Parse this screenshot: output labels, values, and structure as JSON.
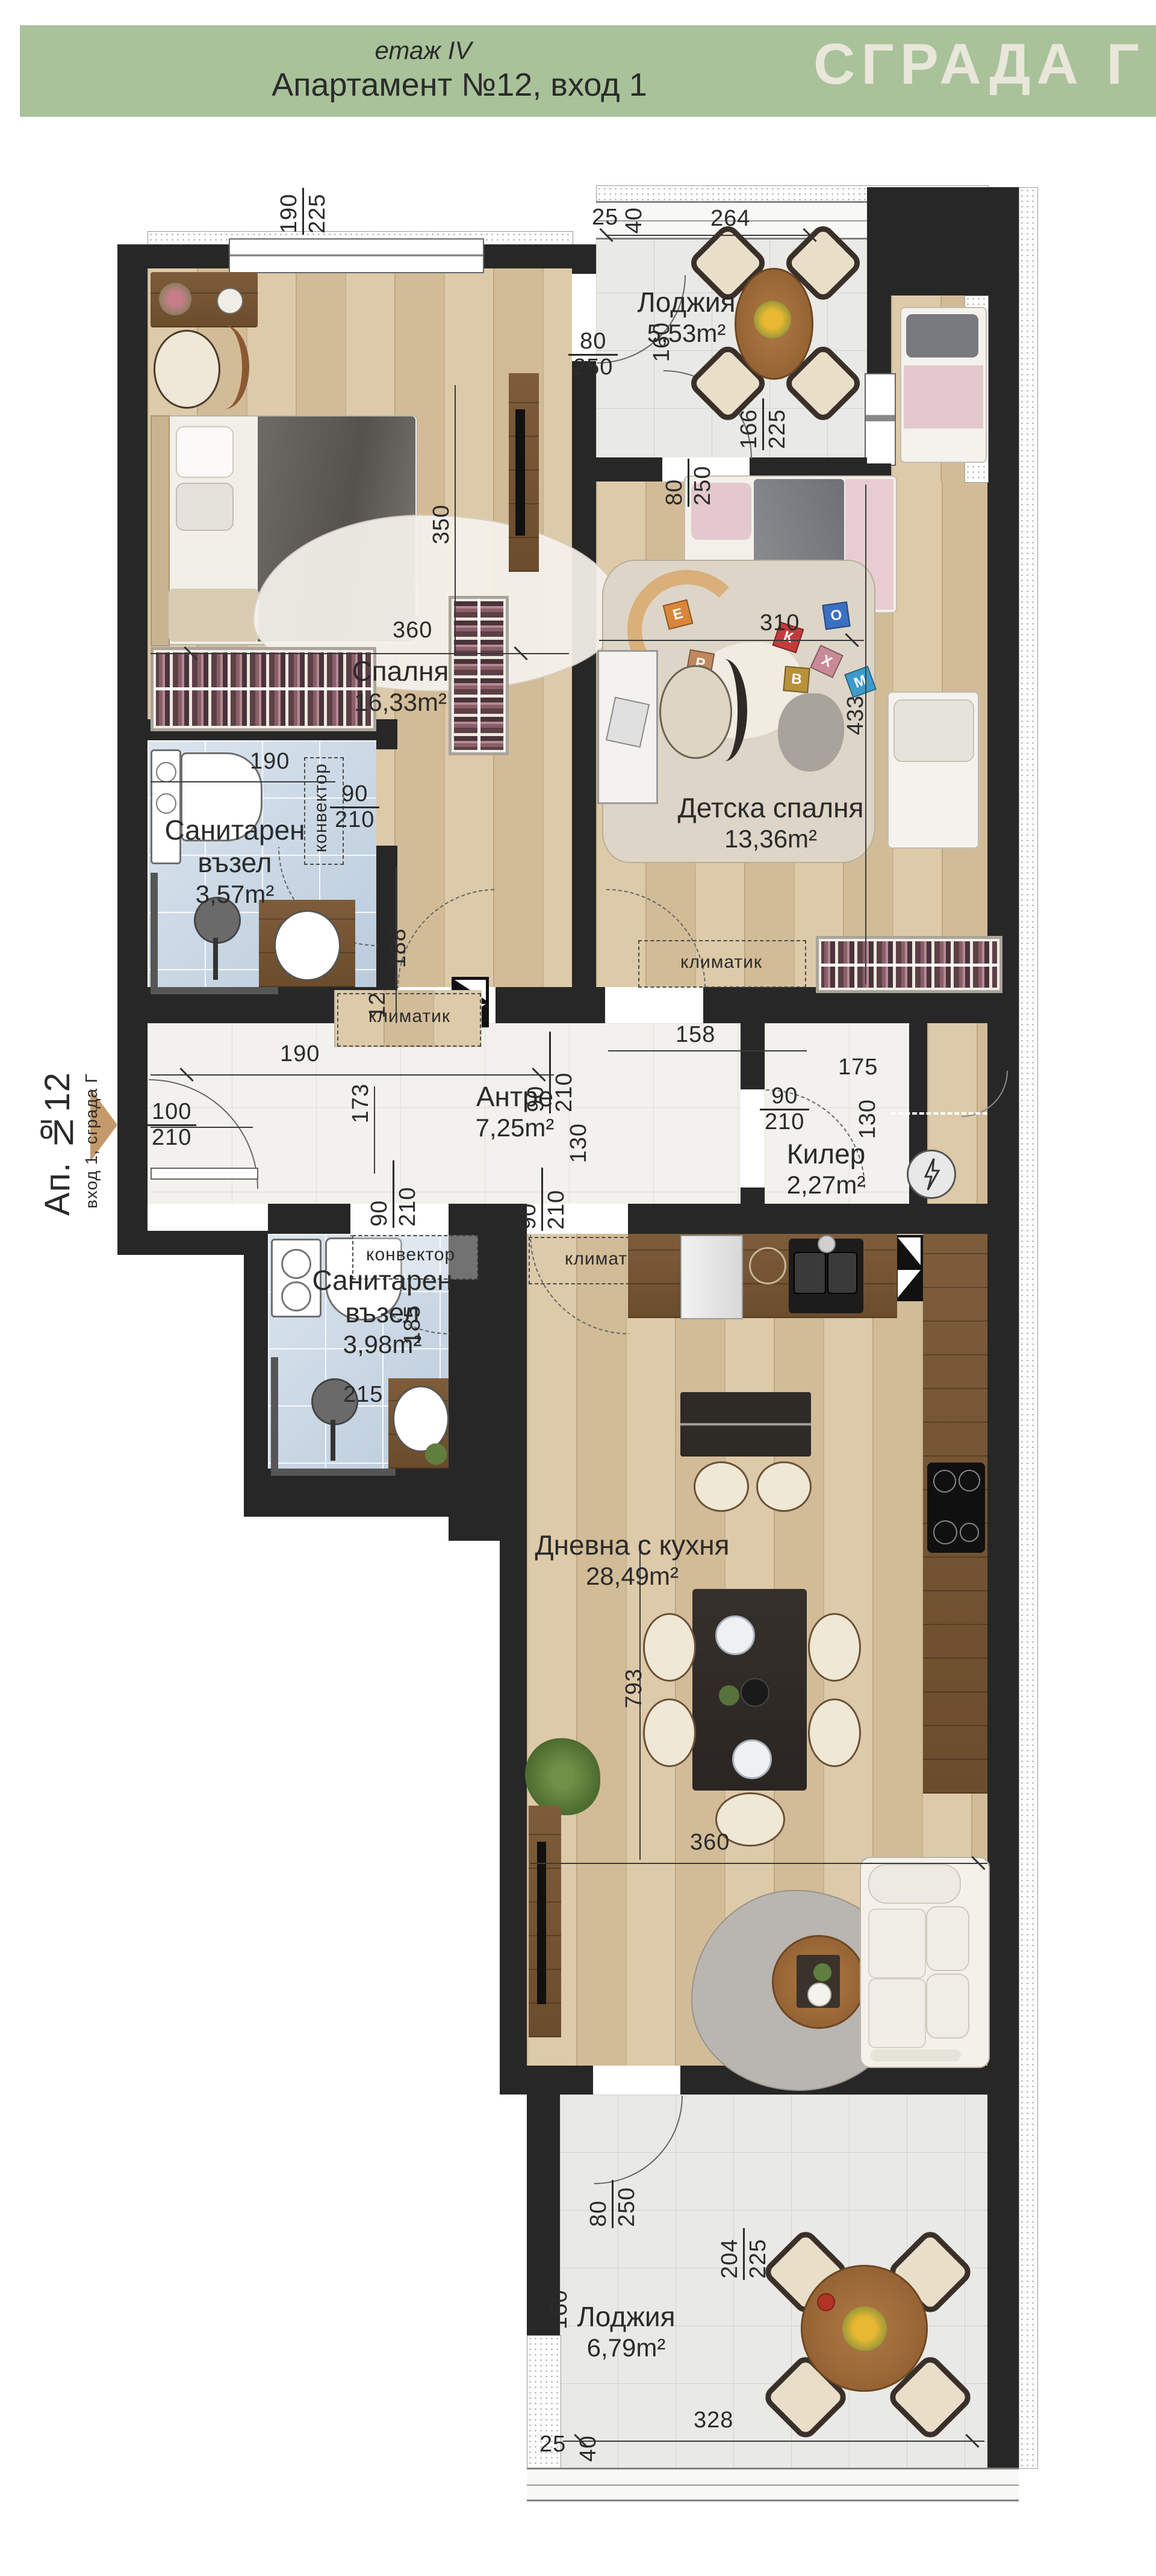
{
  "header": {
    "floor_label": "етаж IV",
    "apartment_title": "Апартамент №12, вход 1",
    "building_badge": "СГРАДА Г"
  },
  "entrance_label": {
    "apartment": "Ап. №12",
    "entrance_line": "вход 1, сграда Г"
  },
  "rooms": {
    "bedroom": {
      "name": "Спалня",
      "area": "16,33m²"
    },
    "kids": {
      "name": "Детска спалня",
      "area": "13,36m²"
    },
    "loggia_top": {
      "name": "Лоджия",
      "area": "5,53m²"
    },
    "bath1": {
      "name_line1": "Санитарен",
      "name_line2": "възел",
      "area": "3,57m²"
    },
    "bath2": {
      "name_line1": "Санитарен",
      "name_line2": "възел",
      "area": "3,98m²"
    },
    "hall": {
      "name": "Антре",
      "area": "7,25m²"
    },
    "closet": {
      "name": "Килер",
      "area": "2,27m²"
    },
    "living": {
      "name": "Дневна с кухня",
      "area": "28,49m²"
    },
    "loggia_bottom": {
      "name": "Лоджия",
      "area": "6,79m²"
    }
  },
  "appliance_labels": {
    "convector": "конвектор",
    "climatic": "климатик"
  },
  "dims": {
    "bw1": "190",
    "bw2": "225",
    "lg25": "25",
    "lg40": "40",
    "lg_w": "264",
    "bd_door_w": "80",
    "bd_door_h": "250",
    "lg_h": "160",
    "kid_door_w": "80",
    "kid_door_h": "250",
    "kid_win_w": "166",
    "kid_win_h": "225",
    "bed_350": "350",
    "bed_360": "360",
    "kid_310": "310",
    "kid_433": "433",
    "b1_190": "190",
    "b1_90": "90",
    "b1_210": "210",
    "b1_188": "188",
    "b1_12": "12",
    "b1_158": "158",
    "h_190": "190",
    "h_100": "100",
    "h_210": "210",
    "h_173": "173",
    "hd1_90": "90",
    "hd1_210": "210",
    "h_130": "130",
    "k_175": "175",
    "k_90": "90",
    "k_210": "210",
    "k_130": "130",
    "hd2_90": "90",
    "hd2_210": "210",
    "hd3_90": "90",
    "hd3_210": "210",
    "b2_185": "185",
    "b2_215": "215",
    "lv_793": "793",
    "lv_360": "360",
    "lb_80": "80",
    "lb_250": "250",
    "lb_160": "160",
    "lb_204": "204",
    "lb_225": "225",
    "lb_328": "328",
    "lb_25": "25",
    "lb_40": "40"
  },
  "toy_blocks": [
    "Е",
    "Р",
    "К",
    "О",
    "Х",
    "М",
    "В"
  ],
  "palette": {
    "banner_green": "#a9c29a",
    "badge_text": "#e9e6da",
    "wall_black": "#272727",
    "wood_floor": "#d8c5a3",
    "wood_dark": "#75552f",
    "tile_gray": "#e9e9e6",
    "marble_white": "#f2f1ed",
    "bath_blue": "#c8d7e5",
    "entrance_arrow": "#c49a6c"
  }
}
